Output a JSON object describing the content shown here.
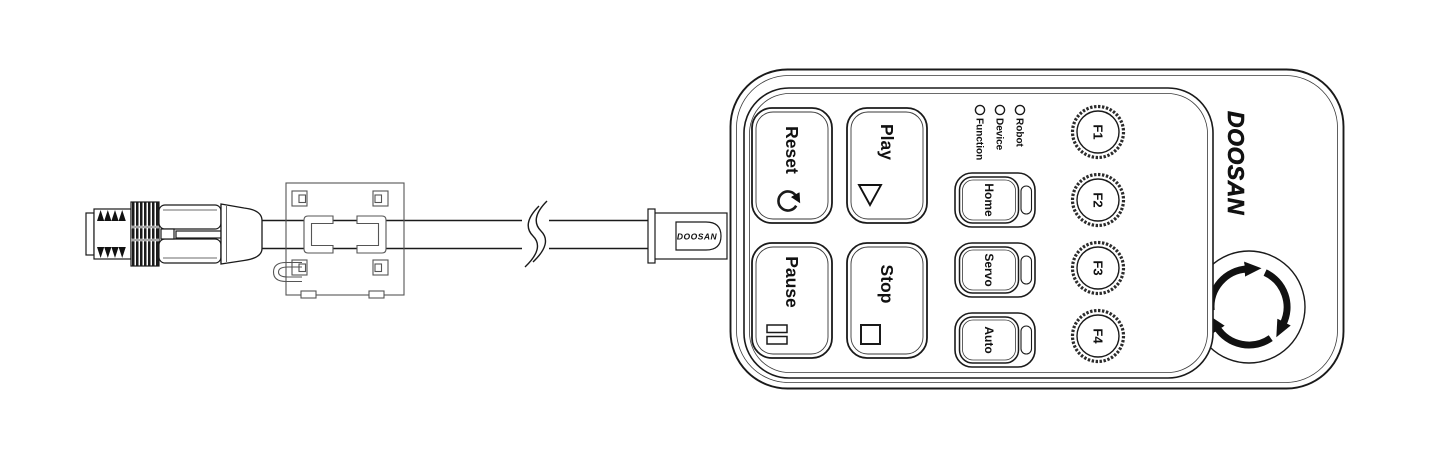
{
  "colors": {
    "outline": "#1a1a1a",
    "ferrite_outline": "#555555",
    "background": "#ffffff"
  },
  "cable": {
    "strain_relief_label": "DOOSAN"
  },
  "pendant": {
    "logo": "DOOSAN",
    "action_buttons": [
      {
        "label": "Reset",
        "icon": "reset-circular-arrow-icon"
      },
      {
        "label": "Play",
        "icon": "play-triangle-icon"
      },
      {
        "label": "Pause",
        "icon": "pause-bars-icon"
      },
      {
        "label": "Stop",
        "icon": "stop-square-icon"
      }
    ],
    "function_buttons": [
      {
        "label": "F1"
      },
      {
        "label": "F2"
      },
      {
        "label": "F3"
      },
      {
        "label": "F4"
      }
    ],
    "mode_buttons": [
      {
        "label": "Home"
      },
      {
        "label": "Servo"
      },
      {
        "label": "Auto"
      }
    ],
    "status_leds": [
      {
        "label": "Robot"
      },
      {
        "label": "Device"
      },
      {
        "label": "Function"
      }
    ],
    "estop": {
      "icon": "rotate-to-release-arrows-icon"
    }
  }
}
